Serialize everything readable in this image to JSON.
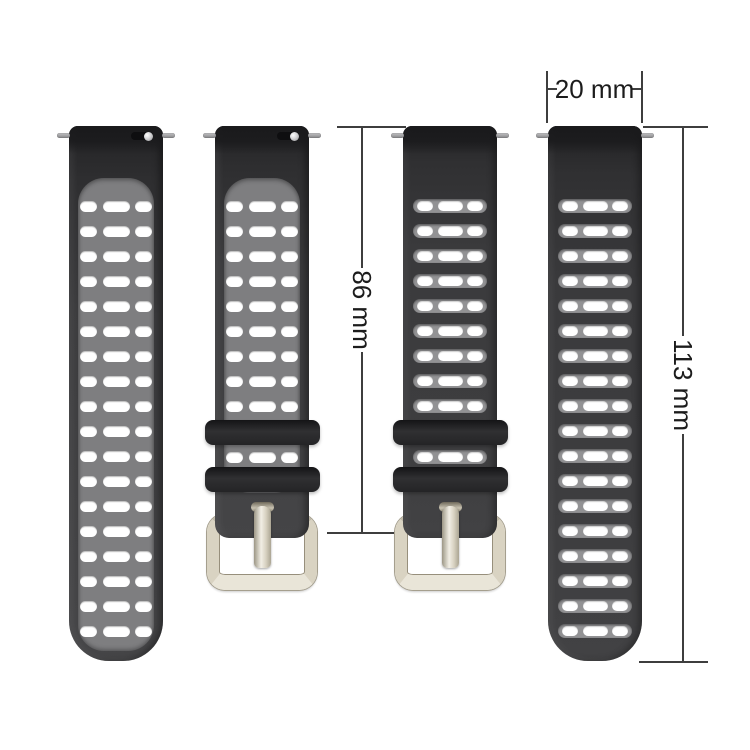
{
  "dimensions": {
    "width_label": "20 mm",
    "buckle_strap_length_label": "86 mm",
    "long_strap_length_label": "113 mm"
  },
  "product": {
    "straps": [
      {
        "name": "strap-front-long",
        "view": "front",
        "hole_rows": 18,
        "rows_between_keepers": 0,
        "has_buckle": false,
        "has_quick_release_lever": true
      },
      {
        "name": "strap-front-buckle",
        "view": "front",
        "hole_rows": 9,
        "rows_between_keepers": 1,
        "has_buckle": true,
        "has_quick_release_lever": true
      },
      {
        "name": "strap-back-buckle",
        "view": "back",
        "hole_rows": 9,
        "rows_between_keepers": 1,
        "has_buckle": true,
        "has_quick_release_lever": false
      },
      {
        "name": "strap-back-long",
        "view": "back",
        "hole_rows": 18,
        "rows_between_keepers": 0,
        "has_buckle": false,
        "has_quick_release_lever": false
      }
    ]
  },
  "colors": {
    "cap": "#1a1a1c",
    "panel": "#7e7e80",
    "band": "#929294",
    "hole": "#ffffff",
    "keeper": "#242426",
    "buckle_light": "#e9e5d8",
    "buckle_mid": "#cdc7b6",
    "buckle_dark": "#978f7c",
    "pin": "#a2a2a4",
    "dim": "#3e3e3e",
    "label": "#1c1c1c"
  }
}
